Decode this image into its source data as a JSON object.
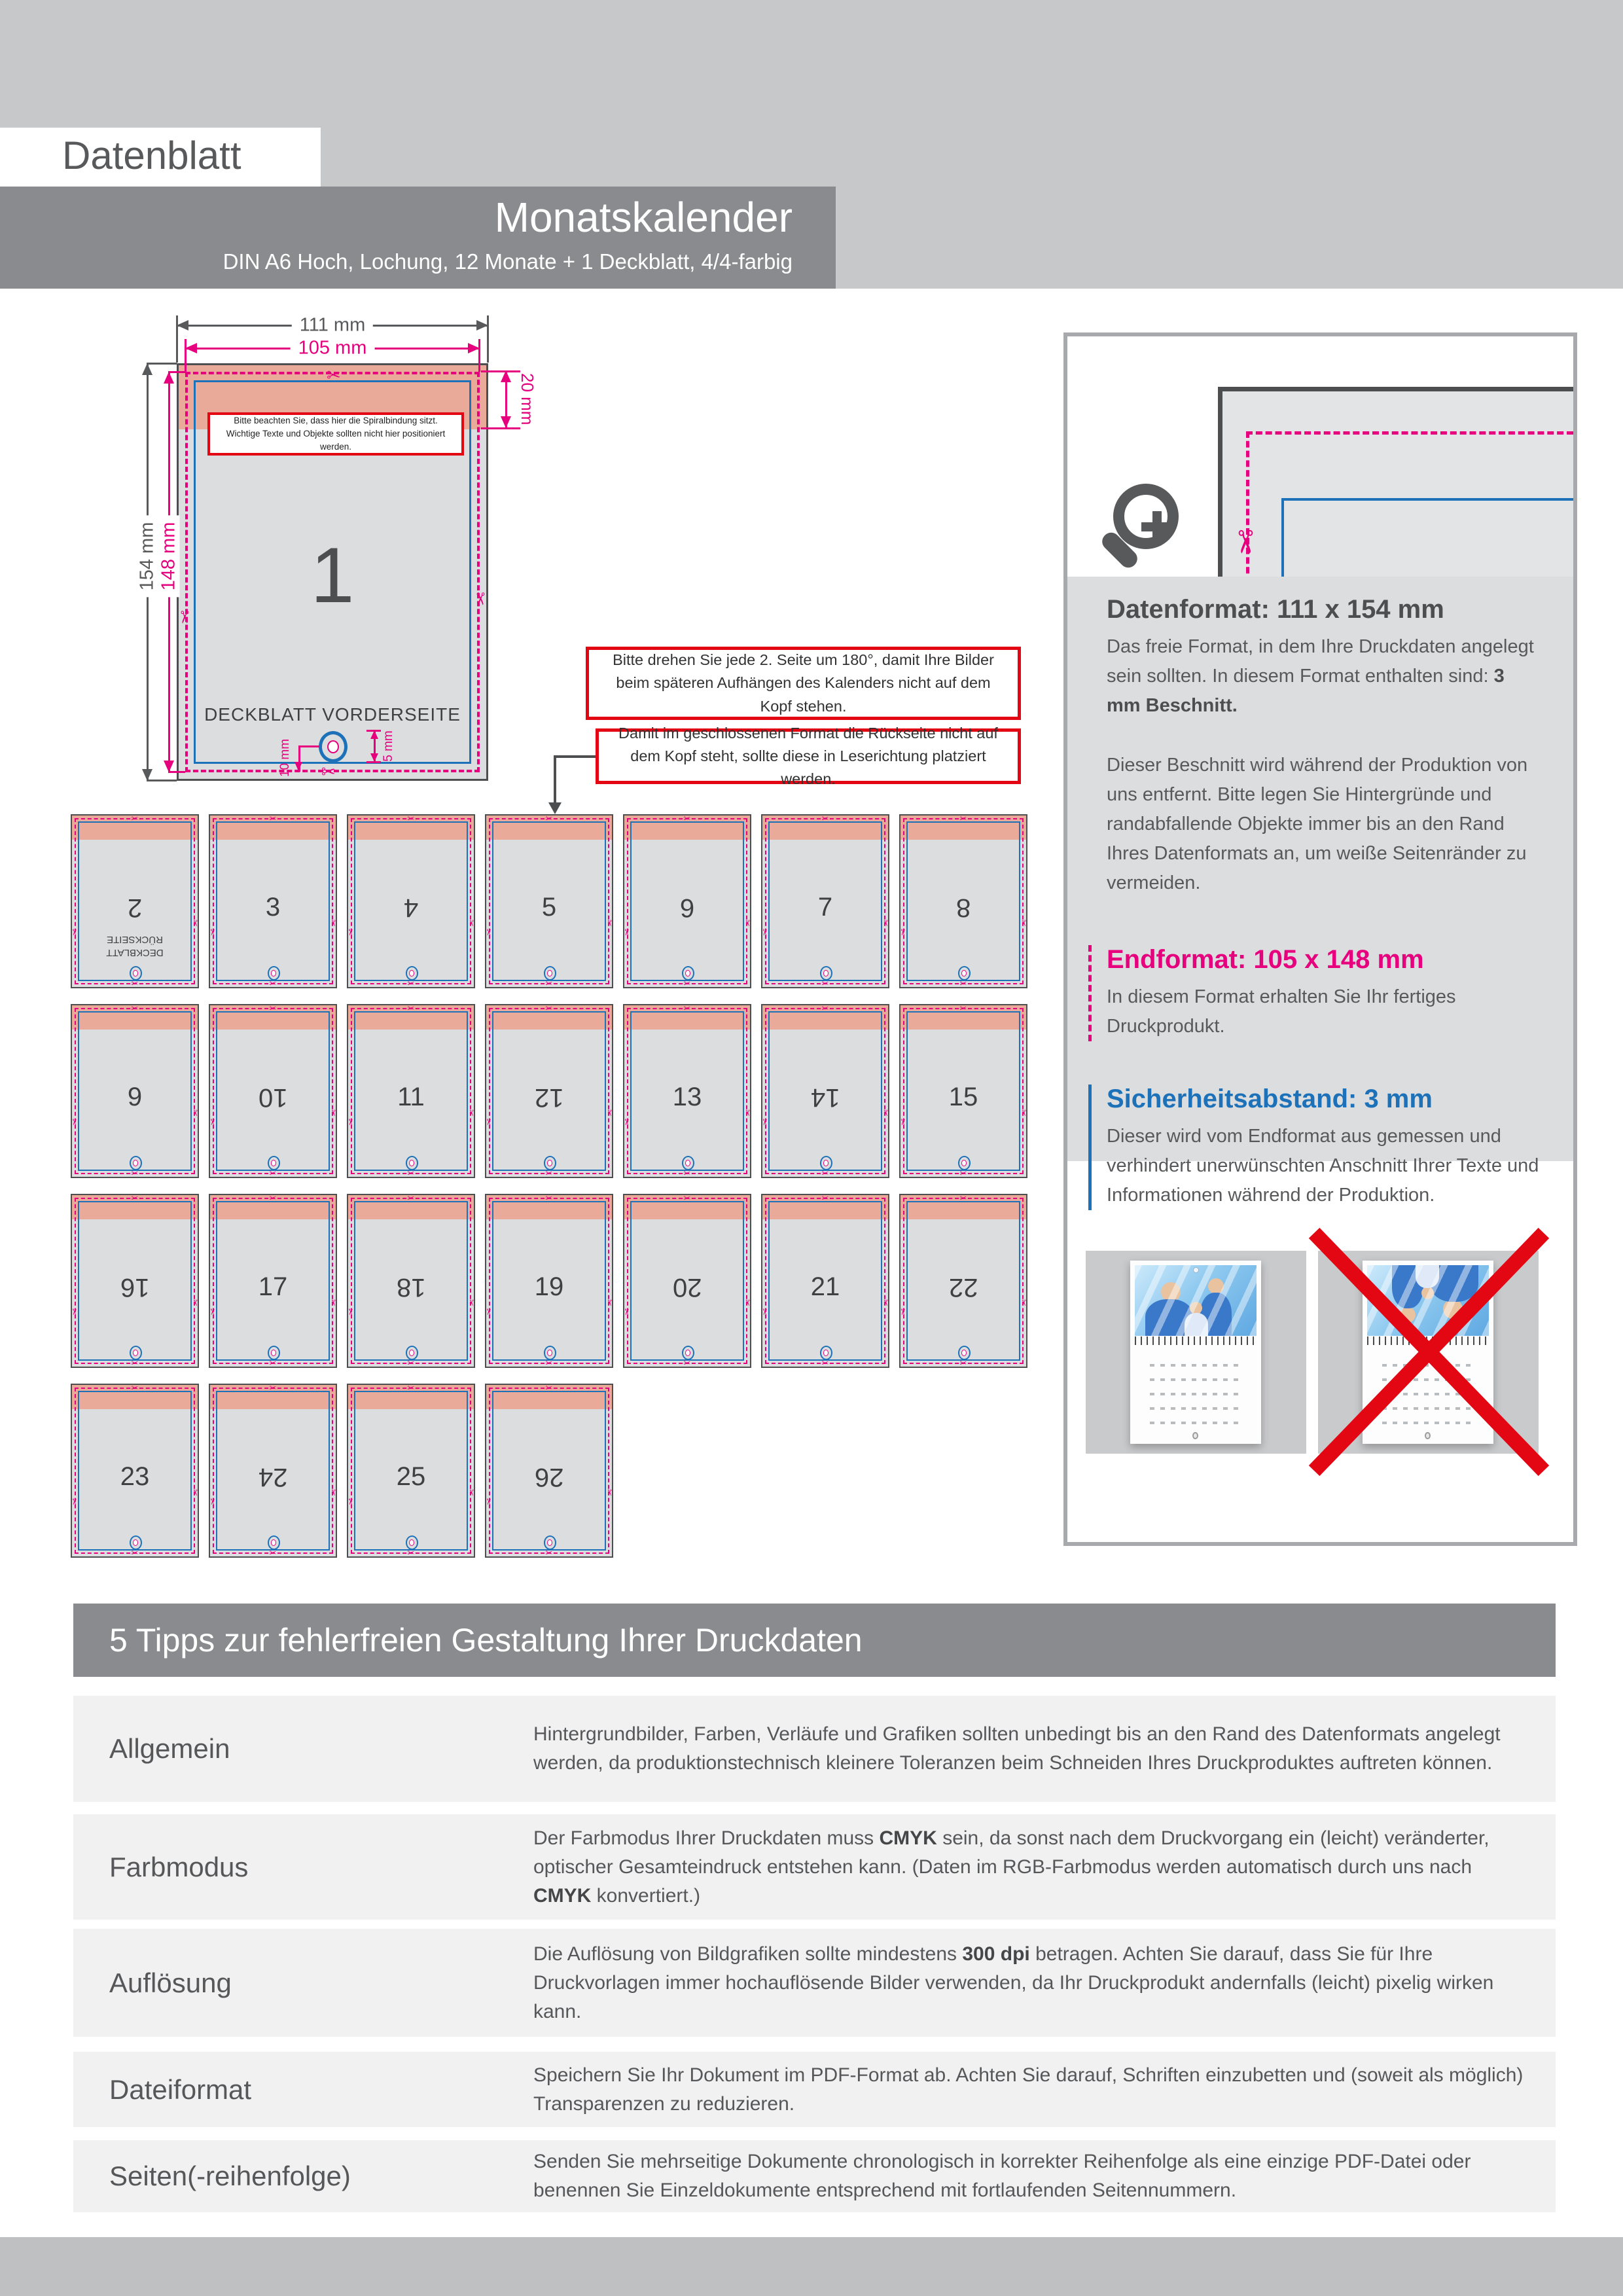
{
  "page": {
    "doc_label": "Datenblatt",
    "title": "Monatskalender",
    "subtitle": "DIN A6 Hoch, Lochung, 12 Monate + 1 Deckblatt, 4/4-farbig"
  },
  "icons": {
    "scissors": "✂",
    "magnifier": "magnifier-plus-icon"
  },
  "colors": {
    "magenta": "#E6007E",
    "blue": "#1D71B8",
    "red": "#E30613",
    "salmon": "#EAAA99"
  },
  "diagram": {
    "width_total": "111 mm",
    "width_trim": "105 mm",
    "height_total": "154 mm",
    "height_trim": "148 mm",
    "binding_zone": "20 mm",
    "hole_offset": "10 mm",
    "hole_height": "5 mm",
    "page_number": "1",
    "page_label": "DECKBLATT VORDERSEITE",
    "warning_line1": "Bitte beachten Sie, dass hier die Spiralbindung sitzt.",
    "warning_line2": "Wichtige Texte und Objekte sollten nicht hier positioniert werden."
  },
  "notes": {
    "rotate": "Bitte drehen Sie jede 2. Seite um 180°, damit Ihre Bilder beim späteren Aufhängen des Kalenders nicht auf dem Kopf stehen.",
    "reading": "Damit im geschlossenen Format die Rückseite nicht auf dem Kopf steht, sollte diese in Leserichtung platziert werden."
  },
  "grid": {
    "pages": [
      {
        "number": "2",
        "rotated": true,
        "label": "DECKBLATT\nRÜCKSEITE"
      },
      {
        "number": "3",
        "rotated": false
      },
      {
        "number": "4",
        "rotated": true
      },
      {
        "number": "5",
        "rotated": false
      },
      {
        "number": "6",
        "rotated": true
      },
      {
        "number": "7",
        "rotated": false
      },
      {
        "number": "8",
        "rotated": true
      },
      {
        "number": "9",
        "rotated": false
      },
      {
        "number": "10",
        "rotated": true
      },
      {
        "number": "11",
        "rotated": false
      },
      {
        "number": "12",
        "rotated": true
      },
      {
        "number": "13",
        "rotated": false
      },
      {
        "number": "14",
        "rotated": true
      },
      {
        "number": "15",
        "rotated": false
      },
      {
        "number": "16",
        "rotated": true
      },
      {
        "number": "17",
        "rotated": false
      },
      {
        "number": "18",
        "rotated": true
      },
      {
        "number": "19",
        "rotated": false
      },
      {
        "number": "20",
        "rotated": true
      },
      {
        "number": "21",
        "rotated": false
      },
      {
        "number": "22",
        "rotated": true
      },
      {
        "number": "23",
        "rotated": false
      },
      {
        "number": "24",
        "rotated": true
      },
      {
        "number": "25",
        "rotated": false
      },
      {
        "number": "26",
        "rotated": true
      }
    ]
  },
  "info": {
    "datenformat": {
      "title": "Datenformat: 111 x 154 mm",
      "p1": [
        {
          "t": "Das freie Format, in dem Ihre Druckdaten angelegt sein sollten. In diesem Format enthalten sind: "
        },
        {
          "t": "3 mm Beschnitt.",
          "b": true
        }
      ],
      "p2": "Dieser Beschnitt wird während der Produktion von uns entfernt. Bitte legen Sie Hintergründe und randabfallende Objekte immer bis an den Rand Ihres Datenformats an, um weiße Seitenränder zu vermeiden."
    },
    "endformat": {
      "title": "Endformat: 105 x 148 mm",
      "text": "In diesem Format erhalten Sie Ihr fertiges Druckprodukt."
    },
    "safety": {
      "title": "Sicherheitsabstand: 3 mm",
      "text": "Dieser wird vom Endformat aus gemessen und verhindert unerwünschten Anschnitt Ihrer Texte und Informationen während der Produktion."
    }
  },
  "tips": {
    "header": "5 Tipps zur fehlerfreien Gestaltung Ihrer Druckdaten",
    "rows": [
      {
        "label": "Allgemein",
        "parts": [
          {
            "t": "Hintergrundbilder, Farben, Verläufe und Grafiken sollten unbedingt bis an den Rand des Datenformats angelegt werden, da produktionstechnisch kleinere Toleranzen beim Schneiden Ihres Druckproduktes auftreten können."
          }
        ]
      },
      {
        "label": "Farbmodus",
        "parts": [
          {
            "t": "Der Farbmodus Ihrer Druckdaten muss "
          },
          {
            "t": "CMYK",
            "b": true
          },
          {
            "t": " sein, da sonst nach dem Druckvorgang ein (leicht) veränderter, optischer Gesamteindruck entstehen kann. (Daten im RGB-Farbmodus werden automatisch durch uns nach "
          },
          {
            "t": "CMYK",
            "b": true
          },
          {
            "t": " konvertiert.)"
          }
        ]
      },
      {
        "label": "Auflösung",
        "parts": [
          {
            "t": "Die Auflösung von Bildgrafiken sollte mindestens "
          },
          {
            "t": "300 dpi",
            "b": true
          },
          {
            "t": " betragen. Achten Sie darauf, dass Sie für Ihre Druckvorlagen immer hochauflösende Bilder verwenden, da Ihr Druckprodukt andernfalls (leicht) pixelig wirken kann."
          }
        ]
      },
      {
        "label": "Dateiformat",
        "parts": [
          {
            "t": "Speichern Sie Ihr Dokument im PDF-Format ab. Achten Sie darauf, Schriften einzubetten und (soweit als möglich) Transparenzen zu reduzieren."
          }
        ]
      },
      {
        "label": "Seiten(-reihenfolge)",
        "parts": [
          {
            "t": "Senden Sie mehrseitige Dokumente chronologisch in korrekter Reihenfolge als eine einzige PDF-Datei oder benennen Sie Einzeldokumente entsprechend mit fortlaufenden Seitennummern."
          }
        ]
      }
    ]
  }
}
